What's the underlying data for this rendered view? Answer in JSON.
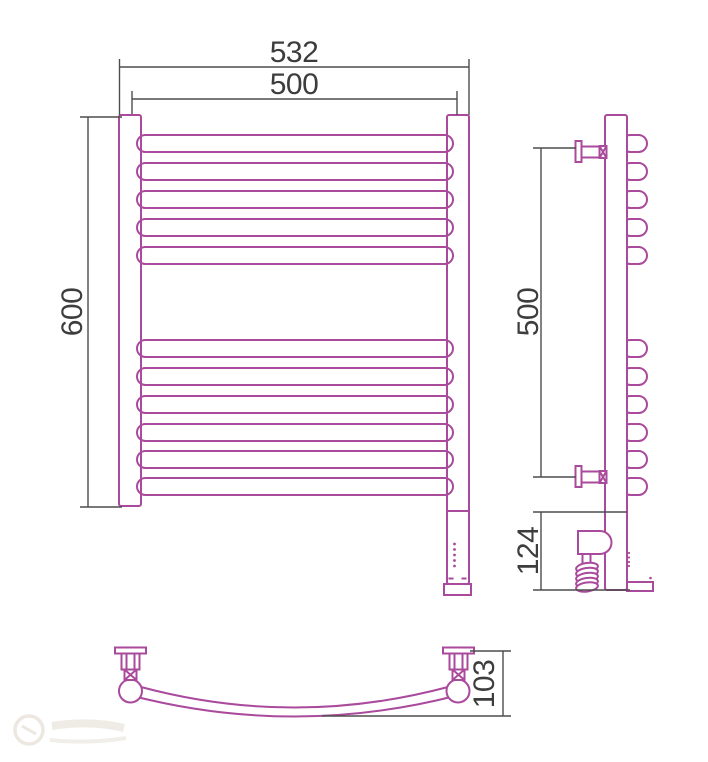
{
  "drawing": {
    "kind": "technical-drawing",
    "product": "curved ladder towel radiator with electric heating element, three orthographic views",
    "colors": {
      "outline": "#aa4a9c",
      "dimension_lines": "#4d4d4d",
      "dimension_text": "#3d3d3d",
      "background": "#ffffff"
    },
    "views": {
      "front": {
        "rung_count_top_group": 5,
        "rung_count_bottom_group": 6,
        "dim_overall_width": "532",
        "dim_rail_width": "500",
        "dim_height": "600"
      },
      "side": {
        "dim_bracket_spacing": "500",
        "dim_lower_section": "124"
      },
      "bottom": {
        "dim_depth": "103"
      }
    }
  }
}
